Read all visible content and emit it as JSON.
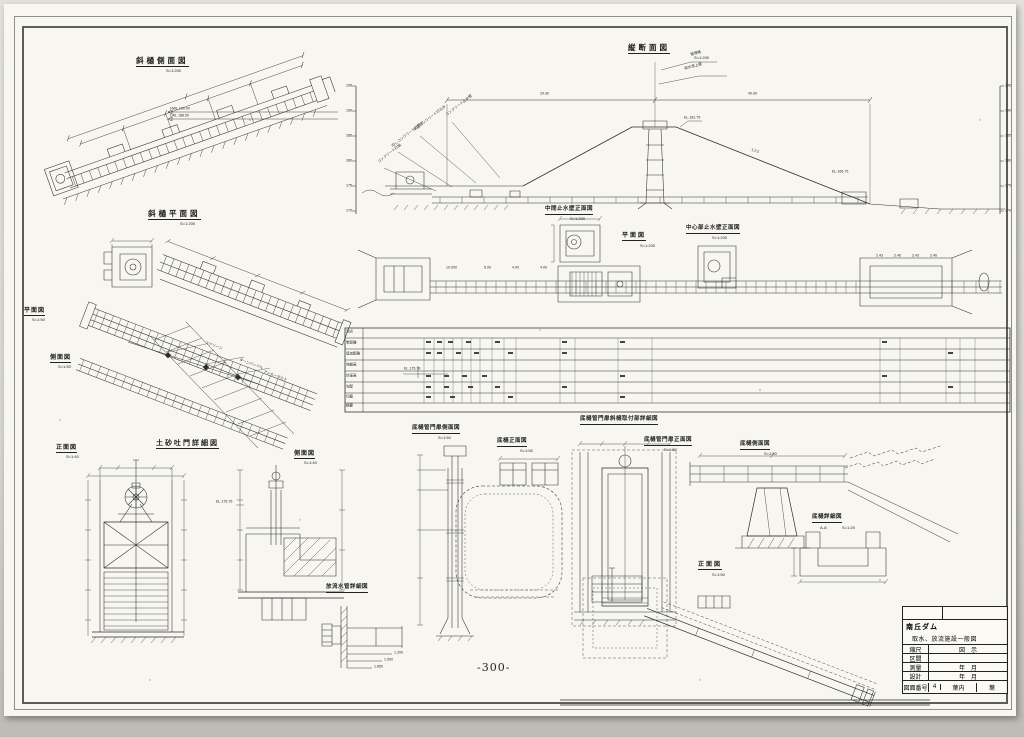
{
  "sheet": {
    "page_number": "-300-"
  },
  "views": {
    "incline_side": {
      "title": "斜樋側面図",
      "scale": "S=1:200",
      "water_levels": [
        "HWL 190.00",
        "LWL 188.50"
      ]
    },
    "profile": {
      "title": "縦断面図",
      "scale": "S=1:200",
      "dim_left": "29.30",
      "dim_right": "40.99",
      "crest_el": "EL.181.75",
      "slope": "1:2.5",
      "slope_el": "EL.166.75",
      "elevations": [
        "195",
        "190",
        "185",
        "180",
        "175",
        "170"
      ],
      "callouts": [
        "管理橋",
        "取水塔上屋",
        "コンクリート止水壁",
        "中詰コンクリート打込み",
        "均しコンクリート打固め",
        "コンクリート打設"
      ]
    },
    "incline_plan": {
      "title": "斜樋平面図",
      "scale": "S=1:200"
    },
    "plan_small": {
      "title": "平面図",
      "scale": "S=1:50",
      "callouts": [
        "スクリーン",
        "ターンバックル",
        "アンカーボルト"
      ]
    },
    "side_small": {
      "title": "側面図",
      "scale": "S=1:50"
    },
    "mid_cutoff": {
      "title": "中間止水壁正面図",
      "scale": "S=1:200"
    },
    "plan_center": {
      "title": "平面図",
      "scale": "S=1:200",
      "dims_left": [
        "10.000",
        "5.00",
        "4.00",
        "4.00"
      ],
      "dims_right": [
        "2.43",
        "2.46",
        "2.43",
        "2.46"
      ]
    },
    "center_cutoff": {
      "title": "中心部止水壁正面図",
      "scale": "S=1:200"
    },
    "sand_gate": {
      "title": "土砂吐門詳細図",
      "front_title": "正面図",
      "front_scale": "S=1:40",
      "side_title": "側面図",
      "side_scale": "S=1:40",
      "el_label": "EL.175.76"
    },
    "conduit_gate_side": {
      "title": "底樋管門扉側面図",
      "scale": "S=1:50"
    },
    "conduit_front": {
      "title": "底樋正面図",
      "scale": "S=1:50"
    },
    "gate_attach": {
      "title": "底樋管門扉斜樋取付部詳細図"
    },
    "conduit_gate_front": {
      "title": "底樋管門扉正面図",
      "scale": "S=1:50"
    },
    "conduit_side": {
      "title": "底樋側面図",
      "scale": "S=1:50"
    },
    "conduit_detail": {
      "title": "底樋詳細図",
      "section": "A-A'",
      "scale": "S=1:20"
    },
    "front_bottom": {
      "title": "正面図",
      "scale": "S=1:50"
    },
    "discharge_detail": {
      "title": "放流水管詳細図",
      "dims": [
        "1.200",
        "1.500",
        "1.850"
      ]
    }
  },
  "profile_table": {
    "row_labels": [
      "測点",
      "単距離",
      "追加距離",
      "地盤高",
      "計画高",
      "勾配",
      "切盛",
      "摘要"
    ],
    "note_el": "EL.175.76"
  },
  "title_block": {
    "project": "南丘ダム",
    "drawing_title": "取水、放流施設一般図",
    "scale_label": "縮尺",
    "scale_value": "図　示",
    "section_label": "区間",
    "section_value": "",
    "survey_label": "測量",
    "survey_value": "年　月",
    "design_label": "設計",
    "design_value": "年　月",
    "number_label": "図面番号",
    "number_value": "4",
    "sheets_label": "葉内",
    "sheets_value": "葉"
  }
}
